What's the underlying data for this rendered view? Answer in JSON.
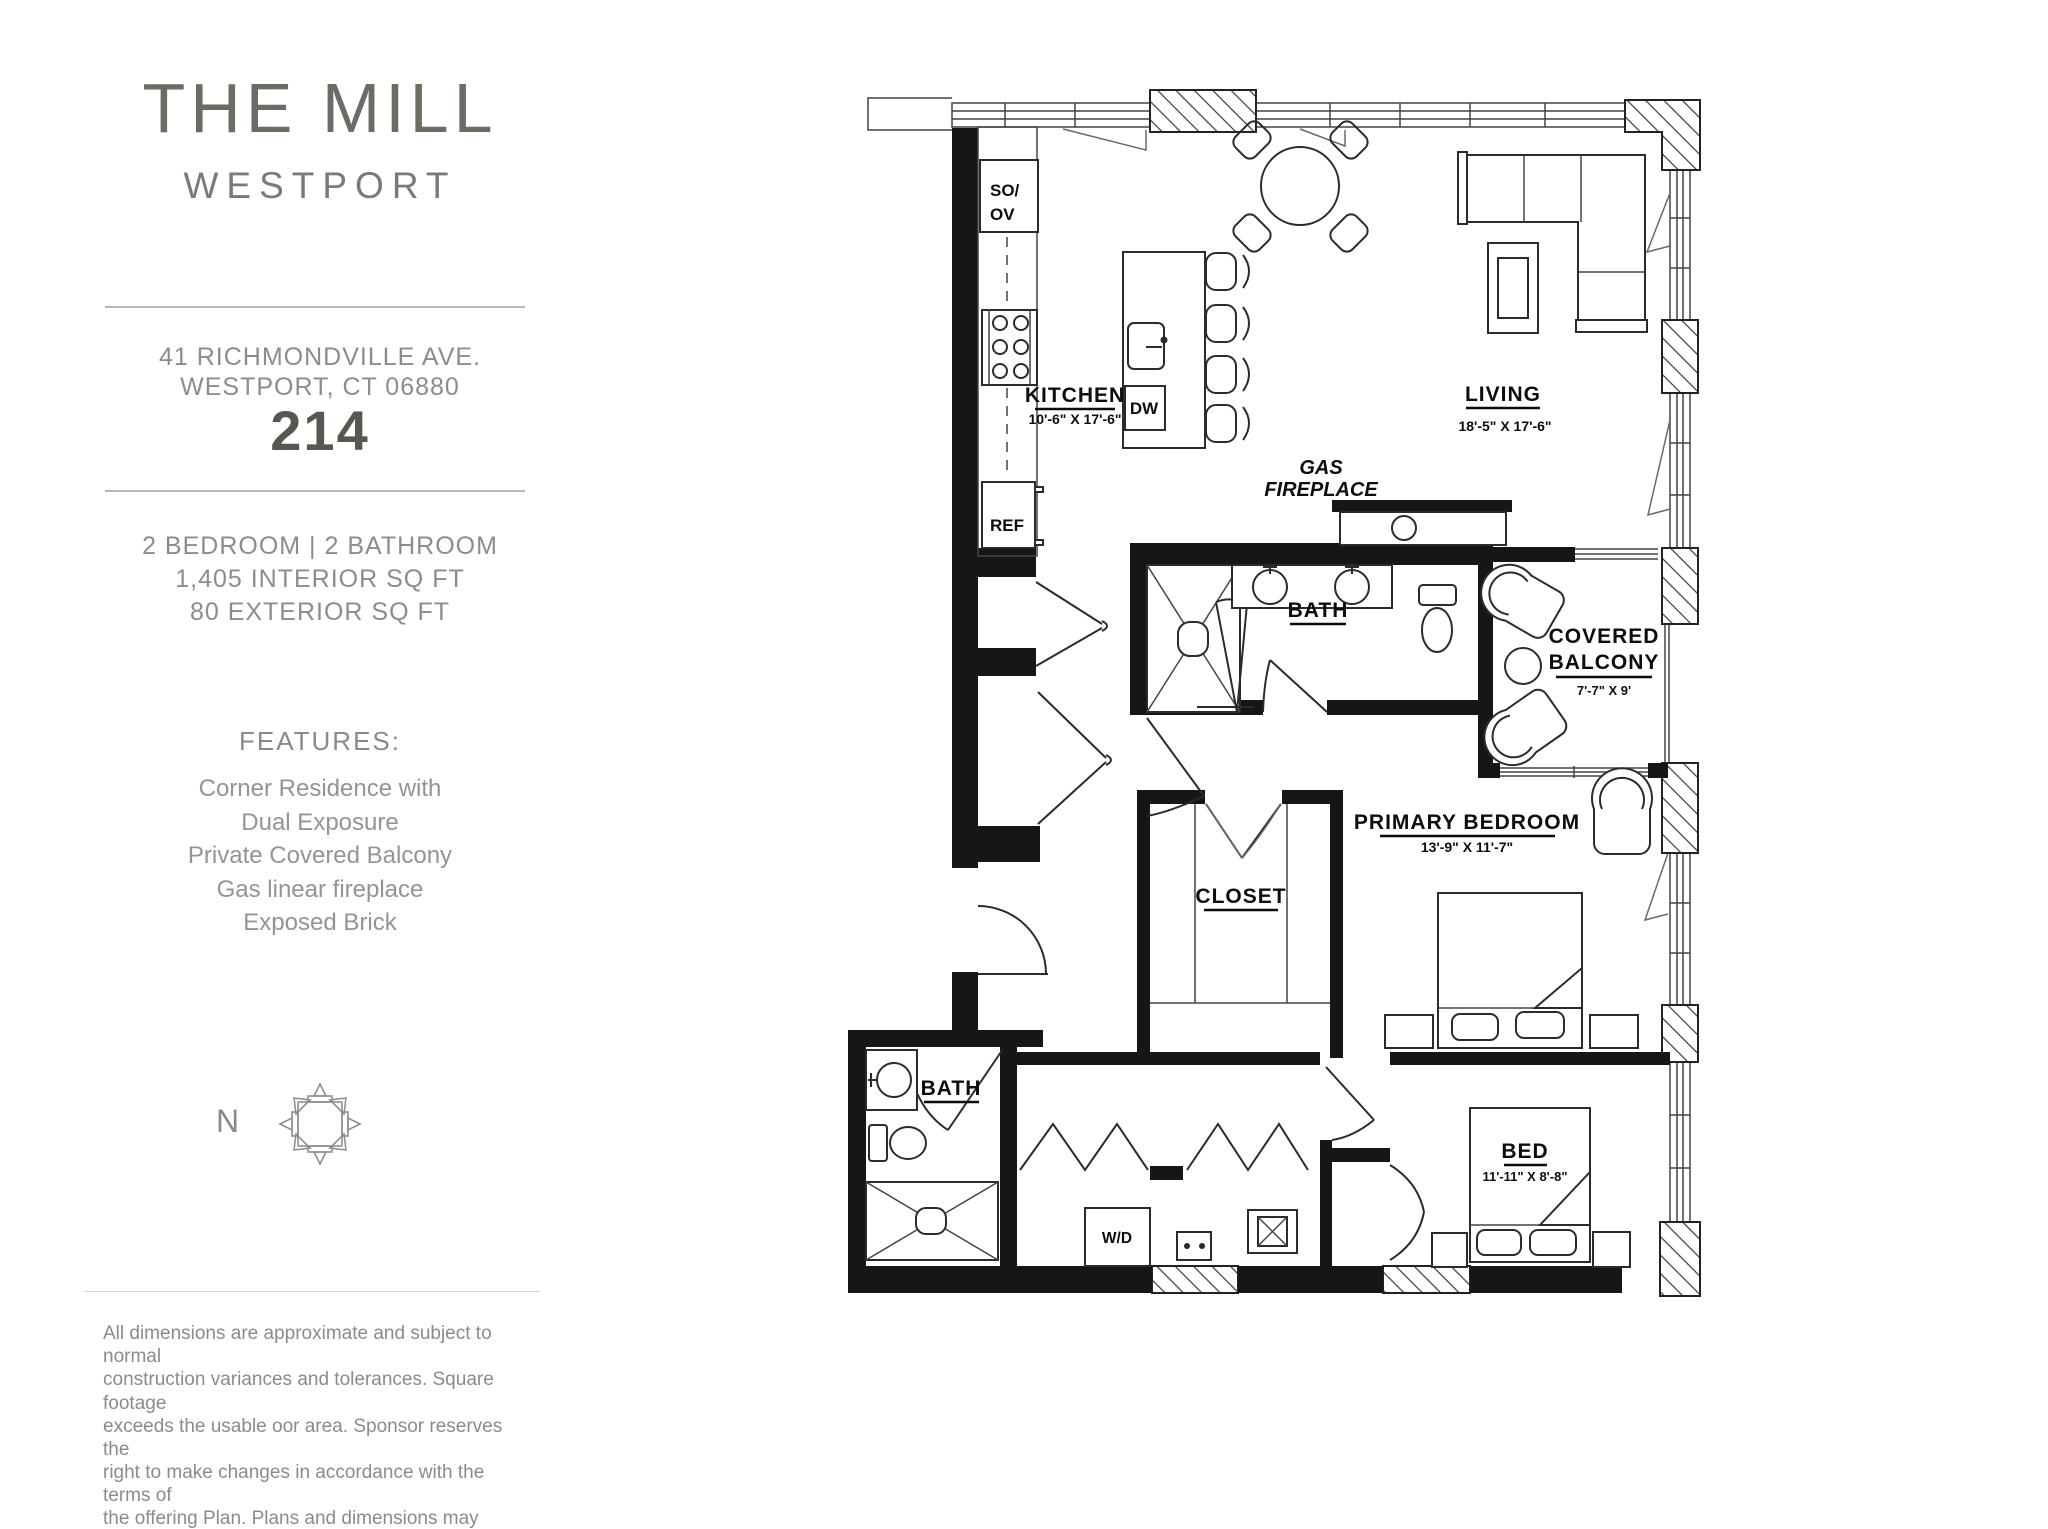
{
  "sidebar": {
    "title": "THE MILL",
    "subtitle": "WESTPORT",
    "address_line1": "41 RICHMONDVILLE AVE.",
    "address_line2": "WESTPORT, CT 06880",
    "unit_number": "214",
    "specs_line1": "2 BEDROOM | 2 BATHROOM",
    "specs_line2": "1,405 INTERIOR SQ FT",
    "specs_line3": "80 EXTERIOR SQ FT",
    "features_heading": "FEATURES:",
    "features": [
      "Corner Residence with",
      "Dual Exposure",
      "Private Covered Balcony",
      "Gas linear fireplace",
      "Exposed Brick"
    ],
    "compass_label": "N",
    "disclaimer_lines": [
      "All dimensions are approximate and subject to normal",
      "construction variances and tolerances. Square footage",
      "exceeds the usable  oor area. Sponsor reserves the",
      "right to make changes in accordance with the terms of",
      "the offering Plan. Plans and dimensions may contain",
      "minor variations from  floor to floor"
    ]
  },
  "floorplan": {
    "kitchen": {
      "label": "KITCHEN",
      "dimensions": "10'-6\" X 17'-6\""
    },
    "living": {
      "label": "LIVING",
      "dimensions": "18'-5\" X 17'-6\""
    },
    "fireplace": {
      "line1": "GAS",
      "line2": "FIREPLACE"
    },
    "primary_bath": {
      "label": "BATH"
    },
    "balcony": {
      "line1": "COVERED",
      "line2": "BALCONY",
      "dimensions": "7'-7\" X 9'"
    },
    "primary_bedroom": {
      "label": "PRIMARY BEDROOM",
      "dimensions": "13'-9\" X 11'-7\""
    },
    "closet": {
      "label": "CLOSET"
    },
    "bath2": {
      "label": "BATH"
    },
    "bedroom2": {
      "label": "BED",
      "dimensions": "11'-11\" X 8'-8\""
    },
    "appliances": {
      "so_ov_line1": "SO/",
      "so_ov_line2": "OV",
      "ref": "REF",
      "dw": "DW",
      "wd": "W/D"
    }
  }
}
